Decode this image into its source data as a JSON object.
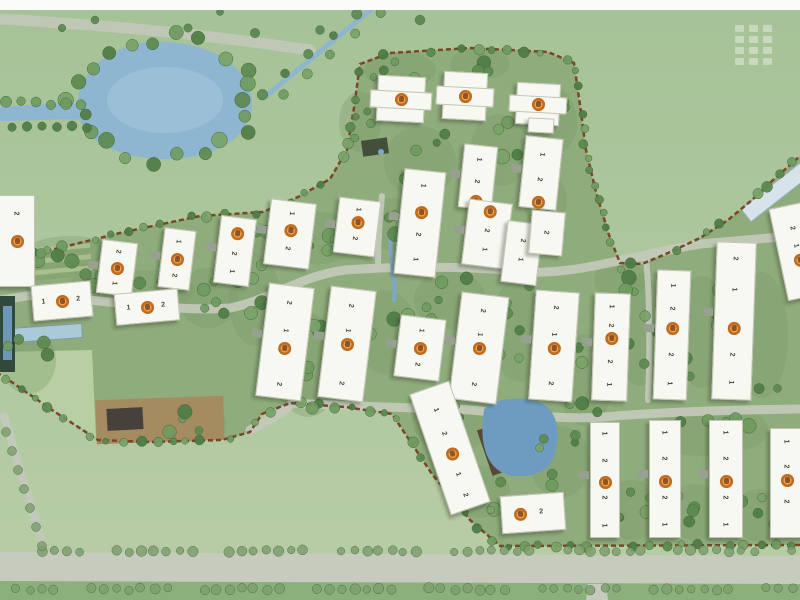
{
  "scene": {
    "label": "Residential community master site plan",
    "canvas": {
      "w": 800,
      "h": 600
    },
    "colors": {
      "field_top": "#a6c297",
      "field_bottom": "#b7cda6",
      "site_fill": "#8fac7c",
      "cluster_shade": "#7a9c69",
      "boundary": "#7b4527",
      "road": "#c3c9ba",
      "south_road_band": "#c6cbbd",
      "hedge": "#8cb07c",
      "water_pond": "#8fb6d0",
      "water_pond_light": "#a5c6da",
      "water_center_pond": "#6d9cc0",
      "water_stream": "#7fa8c4",
      "pool": "#a9cbd8",
      "dark_pool": "#31493a",
      "dark_pool_water": "#6e97b5",
      "building_fill": "#f8f8f3",
      "building_edge": "#c3c3b5",
      "marker_ring": "#c06a20",
      "marker_fill": "#e9bd7d",
      "tree_greens": [
        "#5d8a50",
        "#6f9b60",
        "#4f7c45",
        "#7aa368"
      ],
      "street_tree": "#7f9f6e",
      "deck": "#a58b60",
      "dark_roof": "#46413a",
      "pond_house": "#594933",
      "clubhouse": "#d6e3eb",
      "lawn_sw": "#b7cfa2"
    },
    "boundary_top": [
      [
        0,
        263
      ],
      [
        55,
        249
      ],
      [
        120,
        233
      ],
      [
        200,
        216
      ],
      [
        263,
        212
      ],
      [
        298,
        197
      ],
      [
        330,
        179
      ],
      [
        347,
        150
      ],
      [
        354,
        108
      ],
      [
        360,
        64
      ],
      [
        390,
        53
      ],
      [
        470,
        48
      ],
      [
        548,
        52
      ],
      [
        574,
        63
      ],
      [
        580,
        105
      ],
      [
        586,
        150
      ],
      [
        596,
        192
      ],
      [
        609,
        235
      ],
      [
        620,
        263
      ],
      [
        642,
        264
      ],
      [
        668,
        253
      ],
      [
        700,
        238
      ],
      [
        728,
        220
      ],
      [
        752,
        200
      ],
      [
        772,
        181
      ],
      [
        800,
        156
      ]
    ],
    "boundary_bottom": [
      [
        800,
        545
      ],
      [
        500,
        546
      ],
      [
        470,
        520
      ],
      [
        432,
        474
      ],
      [
        392,
        414
      ],
      [
        345,
        407
      ],
      [
        290,
        403
      ],
      [
        262,
        414
      ],
      [
        250,
        432
      ],
      [
        222,
        440
      ],
      [
        150,
        442
      ],
      [
        98,
        440
      ],
      [
        55,
        412
      ],
      [
        0,
        374
      ]
    ],
    "lawn_sw": [
      [
        0,
        352
      ],
      [
        92,
        350
      ],
      [
        96,
        438
      ],
      [
        55,
        412
      ],
      [
        0,
        374
      ]
    ],
    "roads": {
      "main": "M35,295 C120,302 180,312 230,308 C270,300 300,276 345,270 C400,266 470,266 530,272 C580,274 640,254 700,244 L780,237",
      "south_mid": "M292,403 C360,407 430,408 470,410 C520,414 560,420 604,417 C660,412 720,410 800,409",
      "spur_top": "M378,268 C378,240 380,215 382,196",
      "spur_right": "M646,258 C650,300 650,350 648,400",
      "west_in": "M0,300 C15,298 25,296 35,295",
      "deck_link": "M250,430 C270,420 285,412 292,403",
      "nw_road": "M0,19 C120,26 200,34 310,50",
      "sw_diag": "M4,416 L44,548",
      "south_band": [
        [
          0,
          552
        ],
        [
          800,
          556
        ],
        [
          800,
          584
        ],
        [
          0,
          581
        ]
      ],
      "exit_south": [
        [
          588,
          584
        ],
        [
          606,
          584
        ],
        [
          608,
          600
        ],
        [
          586,
          600
        ]
      ]
    },
    "water": {
      "pond_main": "M78,98 C85,62 120,40 165,42 C215,44 248,68 252,100 C254,128 230,152 185,158 C140,163 95,150 82,124 C78,115 77,107 78,98 Z",
      "pond_inner": {
        "cx": 165,
        "cy": 100,
        "rx": 58,
        "ry": 33
      },
      "pond_arm": "M82,104 C60,102 30,105 0,107 L0,121 C35,121 60,118 84,120 Z",
      "canal": {
        "x1": 265,
        "y1": 97,
        "x2": 373,
        "y2": 8,
        "w": 5
      },
      "center_pond": "M484,410 C490,396 540,394 550,410 C562,424 558,452 550,464 C540,478 510,480 498,470 C486,461 479,441 484,410 Z",
      "stream": "M391,236 C388,256 397,276 394,300",
      "lap_pool": {
        "cx": 47,
        "cy": 333,
        "w": 70,
        "h": 14,
        "rot": -4
      },
      "left_pool": {
        "x": 0,
        "y": 296,
        "w": 15,
        "h": 76
      },
      "left_pool_water": {
        "x": 3,
        "y": 306,
        "w": 9,
        "h": 54
      },
      "pavilion_pond_dot": {
        "cx": 381,
        "cy": 152,
        "r": 3
      }
    },
    "terraces": {
      "x": 22,
      "y": 249,
      "w": 68,
      "strip_h": 4.6,
      "gap": 1,
      "n": 6,
      "rot": -5,
      "colors": [
        "#a9bf90",
        "#88a471"
      ]
    },
    "structures": [
      {
        "name": "deck-platform",
        "cx": 160,
        "cy": 420,
        "w": 128,
        "h": 44,
        "rot": -2,
        "fill": "#a58b60"
      },
      {
        "name": "deck-house",
        "cx": 125,
        "cy": 419,
        "w": 36,
        "h": 22,
        "rot": -3,
        "fill": "#46413a"
      },
      {
        "name": "garden-pavilion",
        "cx": 375,
        "cy": 147,
        "w": 26,
        "h": 16,
        "rot": -8,
        "fill": "#424f3c"
      },
      {
        "name": "pond-house",
        "cx": 497,
        "cy": 449,
        "w": 26,
        "h": 48,
        "rot": -19,
        "fill": "#594933"
      },
      {
        "name": "clubhouse",
        "cx": 776,
        "cy": 192,
        "w": 76,
        "h": 16,
        "rot": -38,
        "fill": "#d6e3eb",
        "stroke": "#9ab0bd"
      }
    ],
    "tree_clusters": [
      [
        70,
        256,
        40,
        12,
        5
      ],
      [
        145,
        290,
        42,
        12,
        5
      ],
      [
        208,
        298,
        22,
        22,
        5
      ],
      [
        255,
        300,
        18,
        38,
        6
      ],
      [
        320,
        238,
        28,
        18,
        4
      ],
      [
        308,
        365,
        26,
        44,
        7
      ],
      [
        385,
        332,
        24,
        34,
        6
      ],
      [
        390,
        224,
        22,
        18,
        4
      ],
      [
        450,
        300,
        28,
        22,
        5
      ],
      [
        452,
        418,
        32,
        28,
        6
      ],
      [
        520,
        330,
        22,
        44,
        6
      ],
      [
        585,
        380,
        20,
        38,
        5
      ],
      [
        640,
        330,
        18,
        48,
        6
      ],
      [
        702,
        332,
        20,
        48,
        6
      ],
      [
        762,
        335,
        18,
        55,
        6
      ],
      [
        700,
        432,
        38,
        16,
        5
      ],
      [
        560,
        462,
        22,
        28,
        6
      ],
      [
        632,
        510,
        22,
        22,
        5
      ],
      [
        695,
        512,
        22,
        20,
        4
      ],
      [
        758,
        515,
        18,
        18,
        4
      ],
      [
        420,
        162,
        28,
        28,
        5
      ],
      [
        500,
        150,
        22,
        28,
        5
      ],
      [
        553,
        122,
        16,
        26,
        4
      ],
      [
        400,
        70,
        28,
        10,
        4
      ],
      [
        480,
        64,
        22,
        8,
        3
      ],
      [
        360,
        122,
        13,
        22,
        4
      ],
      [
        252,
        240,
        16,
        10,
        3
      ],
      [
        95,
        282,
        16,
        12,
        3
      ],
      [
        28,
        360,
        20,
        26,
        4
      ],
      [
        190,
        422,
        28,
        12,
        4
      ],
      [
        480,
        492,
        22,
        18,
        4
      ],
      [
        545,
        200,
        14,
        20,
        3
      ],
      [
        620,
        280,
        18,
        12,
        3
      ],
      [
        740,
        430,
        20,
        12,
        3
      ]
    ],
    "tree_rows": [
      {
        "x1": 40,
        "x2": 798,
        "y": 551,
        "step": 12.5,
        "r": 4.3
      },
      {
        "x1": 15,
        "x2": 798,
        "y": 589,
        "step": 12.5,
        "r": 4.3
      }
    ],
    "diag_row": {
      "from": [
        6,
        432
      ],
      "to": [
        42,
        546
      ],
      "n": 7,
      "r": 4.5
    },
    "field_dots": [
      [
        62,
        28
      ],
      [
        95,
        20
      ],
      [
        188,
        28
      ],
      [
        220,
        12
      ],
      [
        255,
        33
      ],
      [
        320,
        30
      ],
      [
        420,
        20
      ]
    ],
    "watermark": {
      "rows": 4,
      "cols": 3,
      "x": 735,
      "y": 25
    },
    "buildings": [
      {
        "cx": 400,
        "cy": 98,
        "w": 46,
        "h": 44,
        "rot": 3,
        "shape": "cross",
        "m": 0.5,
        "units": []
      },
      {
        "cx": 464,
        "cy": 95,
        "w": 42,
        "h": 46,
        "rot": 3,
        "shape": "cross",
        "m": 0.5,
        "units": []
      },
      {
        "cx": 537,
        "cy": 103,
        "w": 42,
        "h": 40,
        "rot": 3,
        "shape": "cross",
        "m": 0.5,
        "units": []
      },
      {
        "cx": 540,
        "cy": 124,
        "w": 24,
        "h": 13,
        "rot": 3,
        "units": []
      },
      {
        "cx": 477,
        "cy": 176,
        "w": 32,
        "h": 62,
        "rot": 6,
        "m": 0.9,
        "pad": true,
        "units": [
          [
            "1",
            0.22
          ],
          [
            "2",
            0.58
          ]
        ]
      },
      {
        "cx": 540,
        "cy": 172,
        "w": 36,
        "h": 70,
        "rot": 6,
        "m": 0.92,
        "pad": true,
        "units": [
          [
            "1",
            0.24
          ],
          [
            "2",
            0.6
          ]
        ]
      },
      {
        "cx": 419,
        "cy": 222,
        "w": 40,
        "h": 104,
        "rot": 6,
        "m": 0.4,
        "pad": true,
        "units": [
          [
            "1",
            0.14
          ],
          [
            "2",
            0.62
          ],
          [
            "1",
            0.86
          ]
        ]
      },
      {
        "cx": 16,
        "cy": 240,
        "w": 34,
        "h": 90,
        "rot": 0,
        "m": 0.5,
        "units": [
          [
            "2",
            0.2
          ]
        ]
      },
      {
        "cx": 61,
        "cy": 300,
        "w": 58,
        "h": 34,
        "rot": -5,
        "m": 0.5,
        "horiz": true,
        "units": [
          [
            "1",
            0.2
          ],
          [
            "2",
            0.8
          ]
        ]
      },
      {
        "cx": 116,
        "cy": 267,
        "w": 34,
        "h": 52,
        "rot": 7,
        "m": 0.5,
        "pad": true,
        "units": [
          [
            "2",
            0.2
          ],
          [
            "1",
            0.8
          ]
        ]
      },
      {
        "cx": 176,
        "cy": 258,
        "w": 30,
        "h": 58,
        "rot": 7,
        "m": 0.5,
        "pad": true,
        "units": [
          [
            "1",
            0.2
          ],
          [
            "2",
            0.8
          ]
        ]
      },
      {
        "cx": 146,
        "cy": 306,
        "w": 62,
        "h": 30,
        "rot": -5,
        "m": 0.5,
        "horiz": true,
        "units": [
          [
            "1",
            0.22
          ],
          [
            "2",
            0.78
          ]
        ]
      },
      {
        "cx": 234,
        "cy": 250,
        "w": 34,
        "h": 66,
        "rot": 7,
        "m": 0.24,
        "pad": true,
        "units": [
          [
            "2",
            0.55
          ],
          [
            "1",
            0.82
          ]
        ]
      },
      {
        "cx": 289,
        "cy": 233,
        "w": 44,
        "h": 64,
        "rot": 7,
        "m": 0.45,
        "pad": true,
        "units": [
          [
            "1",
            0.18
          ],
          [
            "2",
            0.74
          ]
        ]
      },
      {
        "cx": 356,
        "cy": 226,
        "w": 40,
        "h": 54,
        "rot": 7,
        "m": 0.42,
        "pad": true,
        "units": [
          [
            "1",
            0.18
          ],
          [
            "2",
            0.72
          ]
        ]
      },
      {
        "cx": 486,
        "cy": 233,
        "w": 42,
        "h": 64,
        "rot": 7,
        "m": 0.15,
        "pad": true,
        "units": [
          [
            "2",
            0.45
          ],
          [
            "1",
            0.75
          ]
        ]
      },
      {
        "cx": 521,
        "cy": 252,
        "w": 34,
        "h": 60,
        "rot": 7,
        "units": [
          [
            "2",
            0.3
          ],
          [
            "1",
            0.62
          ]
        ]
      },
      {
        "cx": 546,
        "cy": 232,
        "w": 32,
        "h": 42,
        "rot": 5,
        "units": [
          [
            "2",
            0.5
          ]
        ]
      },
      {
        "cx": 284,
        "cy": 341,
        "w": 44,
        "h": 112,
        "rot": 7,
        "m": 0.56,
        "pad": true,
        "units": [
          [
            "2",
            0.15
          ],
          [
            "1",
            0.4
          ],
          [
            "2",
            0.88
          ]
        ]
      },
      {
        "cx": 346,
        "cy": 343,
        "w": 44,
        "h": 110,
        "rot": 7,
        "m": 0.5,
        "pad": true,
        "units": [
          [
            "2",
            0.15
          ],
          [
            "1",
            0.38
          ],
          [
            "2",
            0.86
          ]
        ]
      },
      {
        "cx": 419,
        "cy": 347,
        "w": 44,
        "h": 60,
        "rot": 7,
        "m": 0.5,
        "pad": true,
        "units": [
          [
            "1",
            0.22
          ],
          [
            "2",
            0.78
          ]
        ]
      },
      {
        "cx": 478,
        "cy": 347,
        "w": 46,
        "h": 106,
        "rot": 7,
        "m": 0.5,
        "pad": true,
        "units": [
          [
            "2",
            0.15
          ],
          [
            "1",
            0.38
          ],
          [
            "2",
            0.85
          ]
        ]
      },
      {
        "cx": 553,
        "cy": 345,
        "w": 42,
        "h": 108,
        "rot": 4,
        "m": 0.52,
        "pad": true,
        "units": [
          [
            "2",
            0.15
          ],
          [
            "1",
            0.4
          ],
          [
            "2",
            0.85
          ]
        ]
      },
      {
        "cx": 610,
        "cy": 346,
        "w": 34,
        "h": 106,
        "rot": 2,
        "m": 0.42,
        "pad": true,
        "units": [
          [
            "1",
            0.12
          ],
          [
            "2",
            0.3
          ],
          [
            "2",
            0.64
          ],
          [
            "1",
            0.86
          ]
        ]
      },
      {
        "cx": 671,
        "cy": 334,
        "w": 32,
        "h": 128,
        "rot": 2,
        "m": 0.45,
        "pad": true,
        "units": [
          [
            "1",
            0.12
          ],
          [
            "2",
            0.3
          ],
          [
            "2",
            0.66
          ],
          [
            "1",
            0.88
          ]
        ]
      },
      {
        "cx": 733,
        "cy": 320,
        "w": 38,
        "h": 156,
        "rot": 2,
        "m": 0.55,
        "pad": true,
        "units": [
          [
            "2",
            0.1
          ],
          [
            "1",
            0.3
          ],
          [
            "2",
            0.72
          ],
          [
            "1",
            0.9
          ]
        ]
      },
      {
        "cx": 797,
        "cy": 250,
        "w": 38,
        "h": 92,
        "rot": -12,
        "m": 0.6,
        "units": [
          [
            "2",
            0.25
          ],
          [
            "1",
            0.45
          ]
        ]
      },
      {
        "cx": 532,
        "cy": 512,
        "w": 62,
        "h": 36,
        "rot": -4,
        "m": 0.3,
        "horiz": true,
        "units": [
          [
            "2",
            0.65
          ]
        ]
      },
      {
        "cx": 604,
        "cy": 479,
        "w": 28,
        "h": 114,
        "rot": 0,
        "m": 0.52,
        "pad": true,
        "units": [
          [
            "1",
            0.1
          ],
          [
            "2",
            0.33
          ],
          [
            "2",
            0.66
          ],
          [
            "1",
            0.9
          ]
        ]
      },
      {
        "cx": 664,
        "cy": 478,
        "w": 30,
        "h": 116,
        "rot": 0,
        "m": 0.52,
        "pad": true,
        "units": [
          [
            "1",
            0.1
          ],
          [
            "2",
            0.33
          ],
          [
            "2",
            0.66
          ],
          [
            "1",
            0.9
          ]
        ]
      },
      {
        "cx": 725,
        "cy": 478,
        "w": 32,
        "h": 116,
        "rot": 0,
        "m": 0.52,
        "pad": true,
        "units": [
          [
            "1",
            0.1
          ],
          [
            "2",
            0.33
          ],
          [
            "2",
            0.66
          ],
          [
            "1",
            0.9
          ]
        ]
      },
      {
        "cx": 786,
        "cy": 482,
        "w": 32,
        "h": 108,
        "rot": 0,
        "m": 0.48,
        "units": [
          [
            "1",
            0.12
          ],
          [
            "2",
            0.35
          ],
          [
            "2",
            0.68
          ]
        ]
      },
      {
        "cx": 449,
        "cy": 447,
        "w": 40,
        "h": 126,
        "rot": -19,
        "m": 0.55,
        "units": [
          [
            "1",
            0.18
          ],
          [
            "2",
            0.38
          ],
          [
            "1",
            0.72
          ],
          [
            "2",
            0.9
          ]
        ]
      }
    ]
  }
}
